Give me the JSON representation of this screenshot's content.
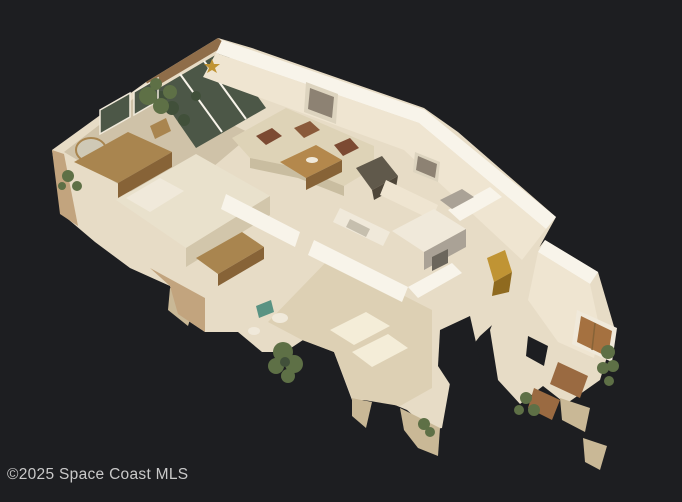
{
  "scene": {
    "description": "3D dollhouse cutaway view of a furnished single-story home (bedroom, living room, kitchen, family room, entry) on a dark backdrop",
    "watermark": {
      "text": "©2025 Space Coast MLS"
    }
  },
  "colors": {
    "bg": "#1d1e21",
    "watermark": "#c9c9c9",
    "wallTop": "#f8f4ea",
    "wallFace": "#e7dcc6",
    "wallFace2": "#efe5d1",
    "wallTan": "#c2a47e",
    "roofEdge": "#8f6d49",
    "glass": "#4c5747",
    "glassLight": "#cfc9b6",
    "plant": "#5e7046",
    "plantDark": "#41503a",
    "carpetBR": "#cfc2a8",
    "carpetWarm": "#ddd0b4",
    "sun": "#f4edd8",
    "bedding": "#e9e1cc",
    "beddingShadow": "#d2c6ab",
    "sofa": "#ded3b7",
    "sofaShadow": "#c9bda0",
    "pillow": "#7c4a32",
    "pillow2": "#8a5a3a",
    "chair": "#60594b",
    "chairDark": "#4e4639",
    "wood": "#a9854f",
    "woodDark": "#876337",
    "woodTop": "#b4884c",
    "counter": "#f0e9da",
    "sink": "#c6bfae",
    "gray": "#aaa296",
    "darkpanel": "#6b665c",
    "frame": "#ddd4bf",
    "art": "#8d8273",
    "tile": "#9a6a41",
    "door": "#a57140",
    "gold": "#c09434",
    "goldDark": "#8f6a1f",
    "teal": "#5a9383",
    "frag": "#c9b896"
  }
}
